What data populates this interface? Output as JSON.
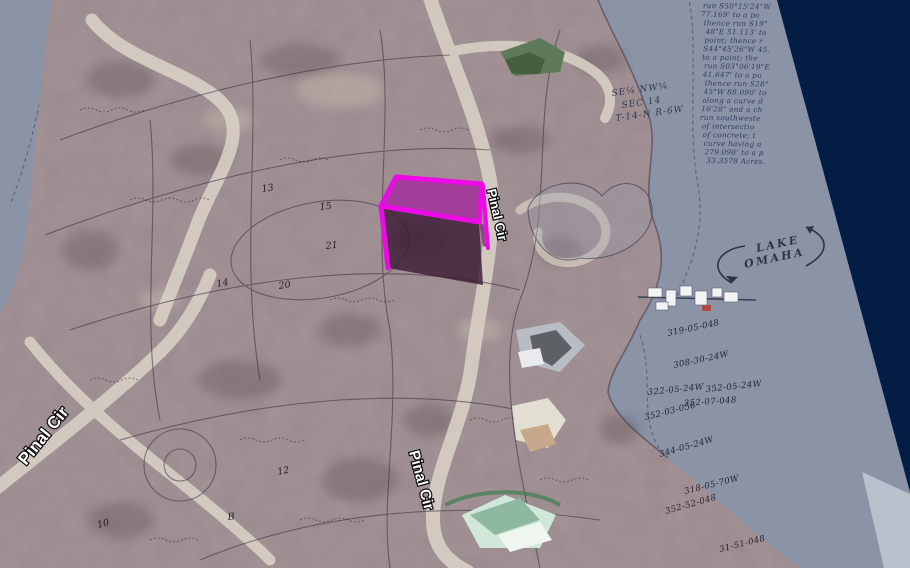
{
  "view": {
    "kind": "3d-aerial-plat-overlay",
    "selected_parcel_note": "magenta extruded parcel box"
  },
  "colors": {
    "background_navy": "#041d45",
    "paper_gray": "#8b93a7",
    "paper_light_strip": "#bac1cc",
    "terrain_base": "#9a8a8e",
    "road_light": "#d9d2c6",
    "ink": "#352e3e",
    "handwriting_ink": "#2e3c5e",
    "parcel_edge_magenta": "#ee0ae6",
    "parcel_top_fill": "#a12b9c",
    "parcel_front_fill": "#3c1c35",
    "parcel_side_fill": "#8c3585",
    "road_label_fill": "#ffffff",
    "road_label_outline": "#0b0b0b"
  },
  "labels": {
    "road": "Pinal Cir"
  },
  "annotations": {
    "lake": [
      "LAKE",
      "OMAHA"
    ],
    "section": [
      "SE¼ NW¼",
      "SEC 14",
      "T-14-N R-6W"
    ],
    "parcel_numbers": [
      "319-05-048",
      "308-30-24W",
      "322-05-24W",
      "352-05-24W",
      "352-07-048",
      "352-03-058",
      "344-05-24W",
      "318-05-70W",
      "352-52-048",
      "31-51-048"
    ],
    "lot_numbers": [
      "13",
      "15",
      "21",
      "14",
      "20",
      "12",
      "10",
      "B"
    ]
  },
  "survey_text": {
    "lines": [
      "run S50°15'24\"W",
      "77.169' to a po",
      "thence run S19°",
      "48\"E 51.113' to",
      "point; thence r",
      "S44°45'26\"W 45.",
      "to a point; the",
      "run S03°06'19\"E",
      "41.647' to a po",
      "thence run S28°",
      "45\"W 88.090' to",
      "along a curve d",
      "16'28\" and a ch",
      "run southweste",
      "of intersectio",
      "of concrete; t",
      "curve having a",
      "279.098' to a p",
      "33.3578 Acres."
    ]
  }
}
